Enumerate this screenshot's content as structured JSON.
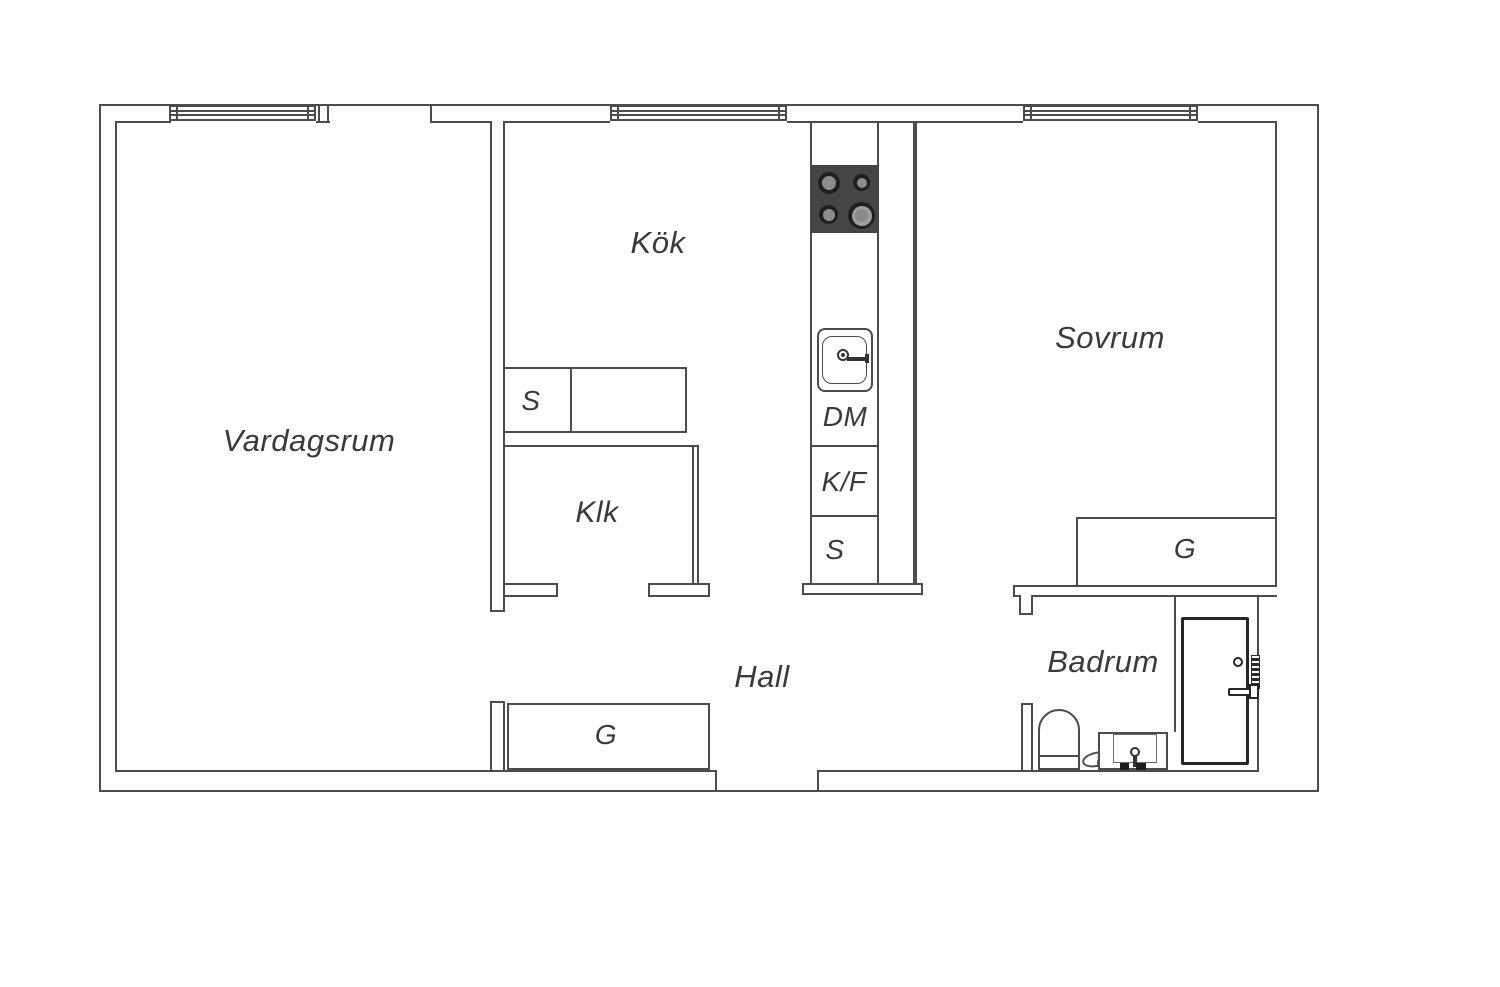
{
  "plan_title": "Apartment floor plan",
  "rooms": {
    "vardagsrum": "Vardagsrum",
    "kok": "Kök",
    "sovrum": "Sovrum",
    "klk": "Klk",
    "hall": "Hall",
    "badrum": "Badrum"
  },
  "fixtures": {
    "counter_s": "S",
    "dm": "DM",
    "kf": "K/F",
    "tall_s": "S",
    "hall_wardrobe": "G",
    "sovrum_wardrobe": "G"
  },
  "colors": {
    "line": "#4c4c4c",
    "text": "#3a3a3a",
    "stove": "#454543",
    "burner_ring": "#1f1f1f",
    "burner_disc": "#8c8c8a",
    "door": "#262626"
  }
}
